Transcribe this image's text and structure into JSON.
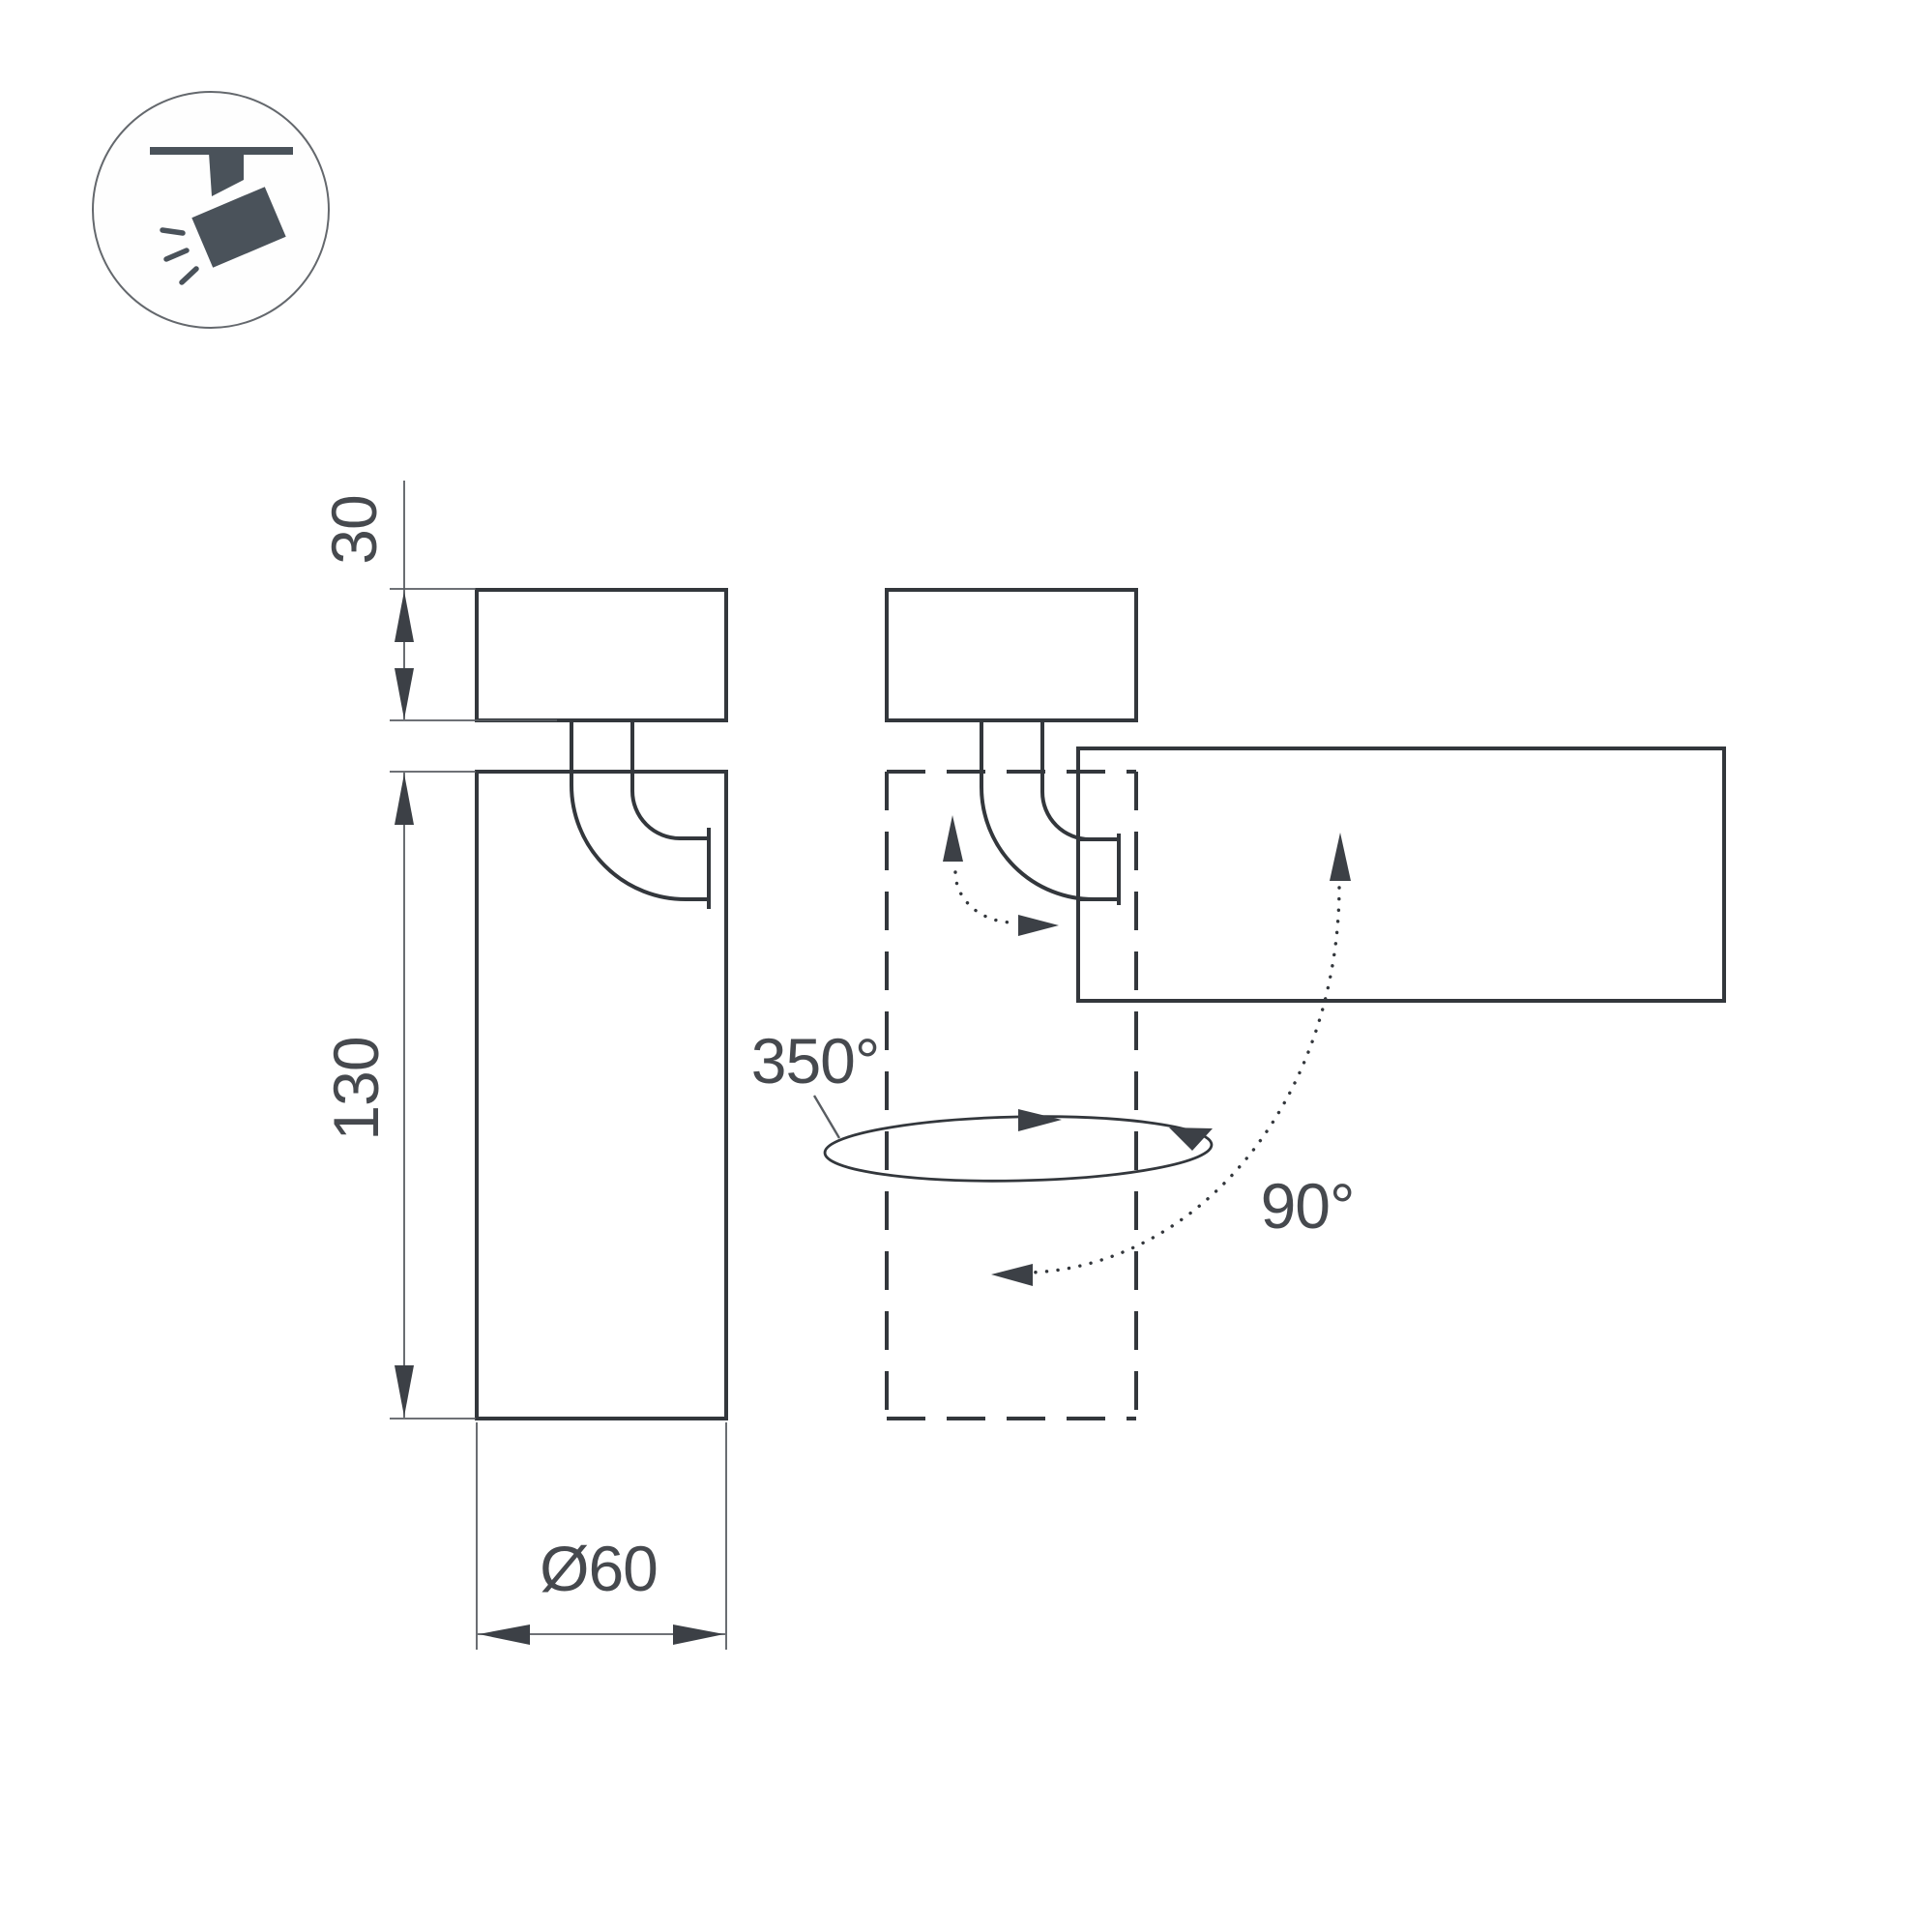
{
  "drawing": {
    "type": "luminaire-dimension-drawing",
    "labels": {
      "base_height": "30",
      "body_height": "130",
      "diameter": "Ø60",
      "rotation_angle": "350°",
      "tilt_angle": "90°"
    },
    "icon": "ceiling-track-spotlight-icon"
  },
  "colors": {
    "line": "#33373c",
    "dim": "#595d62",
    "arrow": "#3c4046",
    "text": "#46494e",
    "icon": "#4a525a",
    "circle": "#64686d"
  }
}
